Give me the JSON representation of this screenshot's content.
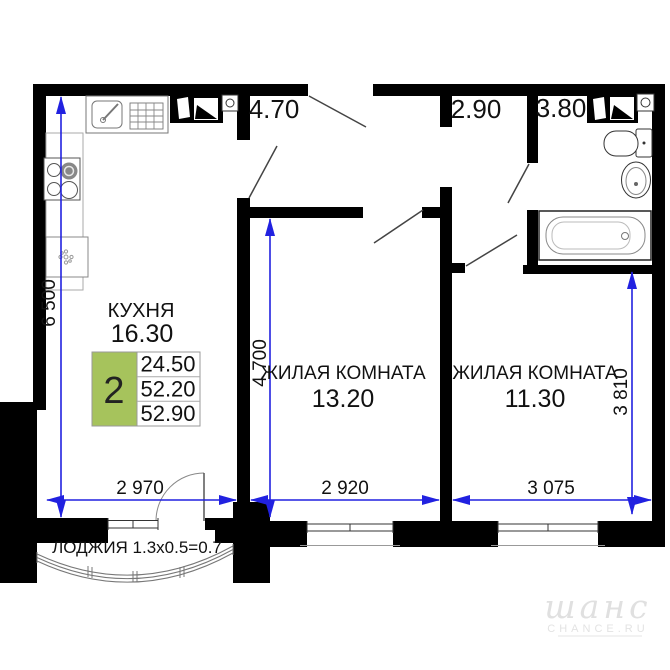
{
  "plan": {
    "kitchen": {
      "name": "КУХНЯ",
      "area": "16.30"
    },
    "room1": {
      "name": "ЖИЛАЯ КОМНАТА",
      "area": "13.20"
    },
    "room2": {
      "name": "ЖИЛАЯ КОМНАТА",
      "area": "11.30"
    },
    "hallway_area": "4.70",
    "corridor_area": "2.90",
    "bathroom_area": "3.80",
    "loggia_label": "ЛОДЖИЯ 1.3x0.5=0.7",
    "dimensions": {
      "kitchen_height": "6 500",
      "room1_height": "4 700",
      "room2_height": "3 810",
      "kitchen_width": "2 970",
      "room1_width": "2 920",
      "room2_width": "3 075"
    },
    "summary_table": {
      "room_count": "2",
      "rows": [
        "24.50",
        "52.20",
        "52.90"
      ]
    },
    "watermark": {
      "script": "шанс",
      "caption": "CHANCE.RU"
    }
  },
  "colors": {
    "wall": "#000000",
    "dimension_blue": "#2121e0",
    "table_green": "#a6c35c",
    "watermark_gray": "#e0e0e0"
  }
}
